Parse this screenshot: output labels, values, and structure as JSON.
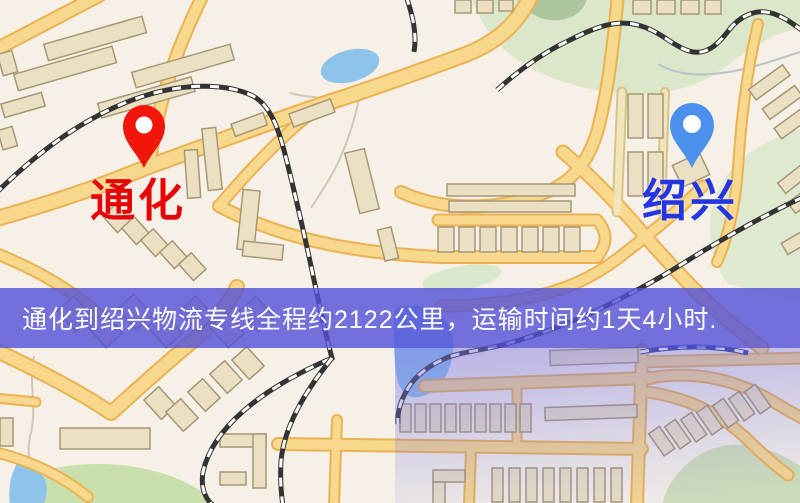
{
  "banner": {
    "text": "通化到绍兴物流专线全程约2122公里，运输时间约1天4小时."
  },
  "map": {
    "origin": {
      "name": "通化"
    },
    "destination": {
      "name": "绍兴"
    }
  },
  "route": {
    "distance_km": 2122,
    "duration": "1天4小时"
  },
  "colors": {
    "origin_label": "#e60404",
    "destination_label": "#2536e0",
    "origin_pin": "#f2150b",
    "destination_pin": "#4b90ec",
    "banner_bg": "rgba(82,80,216,0.8)",
    "banner_text": "#ffffff",
    "road": "#f8d88c",
    "water": "#8ec3ea",
    "park": "#dce7c9"
  }
}
